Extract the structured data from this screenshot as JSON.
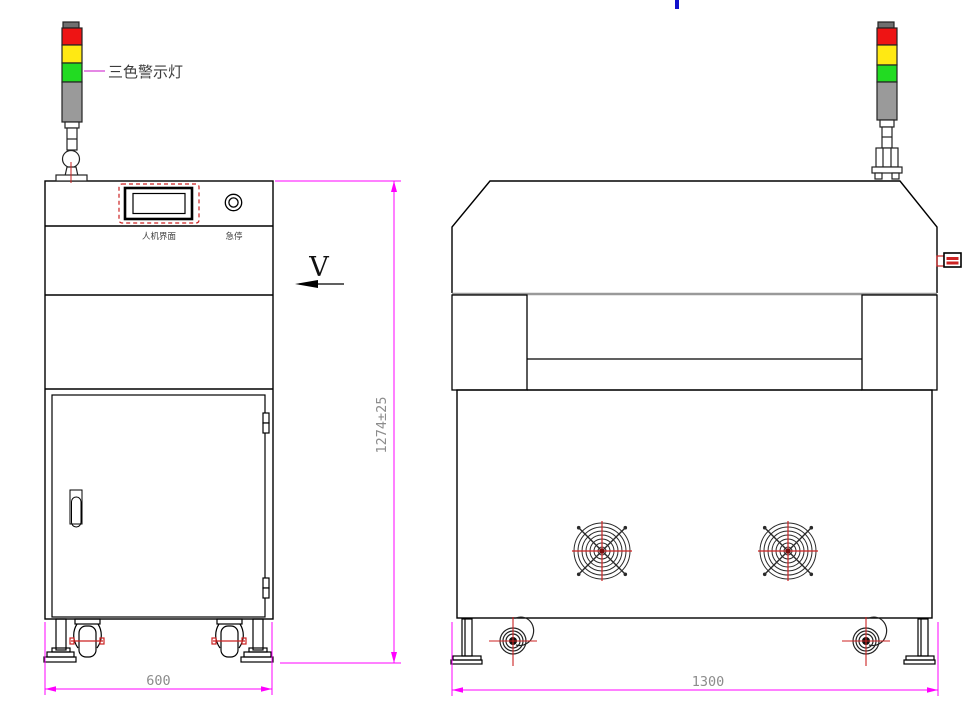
{
  "labels": {
    "tower_light": "三色警示灯",
    "hmi": "人机界面",
    "estop": "急停",
    "view_dir": "V"
  },
  "dimensions": {
    "height": "1274±25",
    "side_width": "600",
    "front_width": "1300"
  },
  "colors": {
    "dimension_line": "#FF00FF",
    "detail_red": "#CC2222",
    "light_red": "#EE1414",
    "light_yellow": "#FFE913",
    "light_green": "#22DB22",
    "light_gray": "#9A9A9A",
    "light_cap": "#6F6F6F",
    "outline": "#000000",
    "dim_text_gray": "#8C8C8C",
    "artifact_blue": "#1111CC"
  }
}
